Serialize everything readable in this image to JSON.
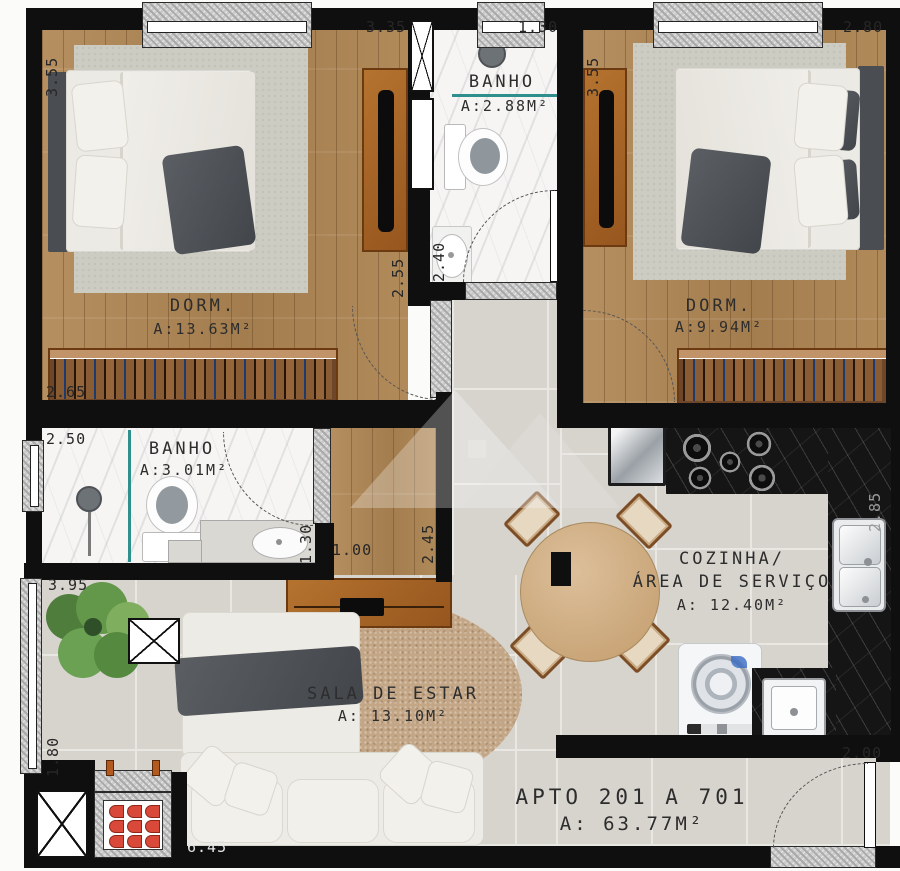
{
  "apartment": {
    "title": "APTO 201 A 701",
    "area": "A: 63.77M²"
  },
  "rooms": {
    "dorm1": {
      "label": "DORM.",
      "area": "A:13.63M²"
    },
    "dorm2": {
      "label": "DORM.",
      "area": "A:9.94M²"
    },
    "banho1": {
      "label": "BANHO",
      "area": "A:2.88M²"
    },
    "banho2": {
      "label": "BANHO",
      "area": "A:3.01M²"
    },
    "cozinha": {
      "label_line1": "COZINHA/",
      "label_line2": "ÁREA DE SERVIÇO",
      "area": "A: 12.40M²"
    },
    "sala": {
      "label": "SALA DE ESTAR",
      "area": "A: 13.10M²"
    }
  },
  "dimensions": {
    "dorm1_height": "3.55",
    "dorm1_width": "3.35",
    "banho1_width": "1.30",
    "banho1_depth": "2.40",
    "dorm2_height": "3.55",
    "dorm2_width": "2.80",
    "dorm1_door_side": "2.55",
    "wardrobe1_width": "2.65",
    "banho2_width": "2.50",
    "banho2_niche": "1.30",
    "hall_width": "1.00",
    "hall_depth": "2.45",
    "varanda_height": "3.95",
    "varanda_lower": "1.80",
    "sala_width": "6.45",
    "cozinha_depth": "2.85",
    "entry_door": "2.00"
  },
  "colors": {
    "wall": "#0f0f0f",
    "glass": "#2e8f8c",
    "coals": "#d8493a",
    "wood_floor": "#b08a5c",
    "tile": "#d7d4ce",
    "counter_dark": "#151515"
  }
}
